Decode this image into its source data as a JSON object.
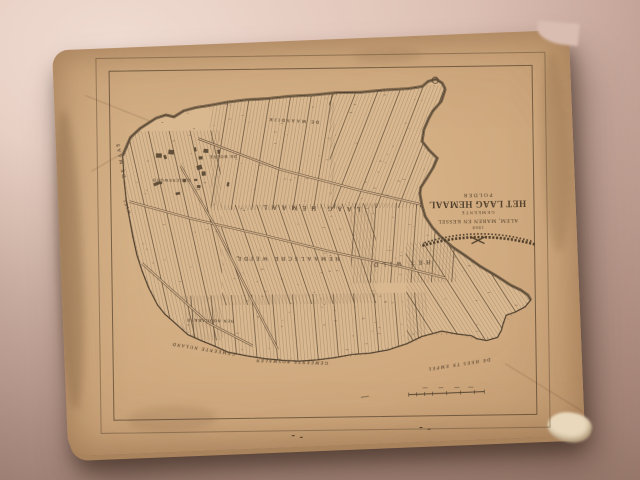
{
  "photo": {
    "background_color": "#d2b2a6",
    "board_color": "#d2ab80",
    "ink_color": "#6d5942",
    "shadow_color": "#2f221a",
    "orientation": "page photographed rotated 180 degrees"
  },
  "title_block": {
    "line1": "POLDER",
    "line2": "HET LAAG HEMAAL",
    "line3": "GEMEENTE",
    "line4": "ALEM, MAREN EN KESSEL",
    "year": "1868"
  },
  "labels": {
    "region_upper": "LAAG HEMAAL",
    "region_lower": "HEMAALSCHE WEIDE",
    "region_wild": "HET WILD",
    "dike_top": "DE MAASDIJK",
    "river_left": "DE MAAS",
    "wiel_left": "WIEL",
    "hamlet_groenewoud": "GROENEWOUD",
    "hamlet_hoeve": "DE HOEVE",
    "field_hoogakker": "DEN HOOGAKKER",
    "boundary_nuland": "GEMEENTE NULAND",
    "boundary_rosmalen": "GEMEENTE ROSMALEN",
    "boundary_empel": "DE HEES TE EMPEL"
  }
}
